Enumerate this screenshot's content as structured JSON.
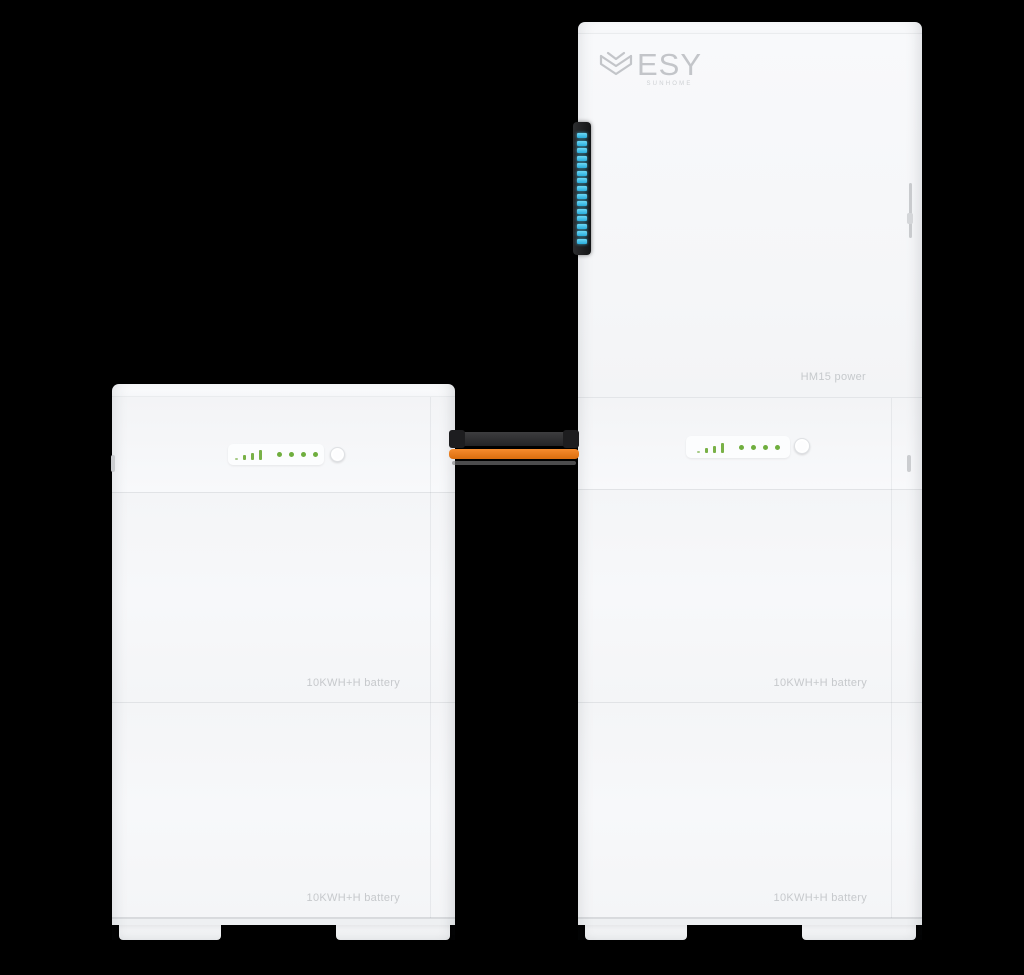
{
  "scene": {
    "background_color": "#000000",
    "product": "ESY SUNHOME HM15 home energy storage system"
  },
  "brand": {
    "name": "ESY",
    "subname": "SUNHOME"
  },
  "left_tower": {
    "battery_modules": [
      {
        "label": "10KWH+H battery"
      },
      {
        "label": "10KWH+H battery"
      }
    ],
    "status_panel": {
      "signal_bars": 4,
      "dots": 4
    }
  },
  "right_tower": {
    "power_label": "HM15 power",
    "led_strip": {
      "segment_count": 15
    },
    "battery_modules": [
      {
        "label": "10KWH+H battery"
      },
      {
        "label": "10KWH+H battery"
      }
    ],
    "status_panel": {
      "signal_bars": 4,
      "dots": 4
    }
  },
  "palette": {
    "led_green": "#74ae41",
    "led_cyan": "#3fc3ec",
    "cable_orange": "#ee7c1b",
    "cable_black": "#29292b",
    "body_white": "#f6f7f9",
    "label_text": "#c6c9cc"
  }
}
